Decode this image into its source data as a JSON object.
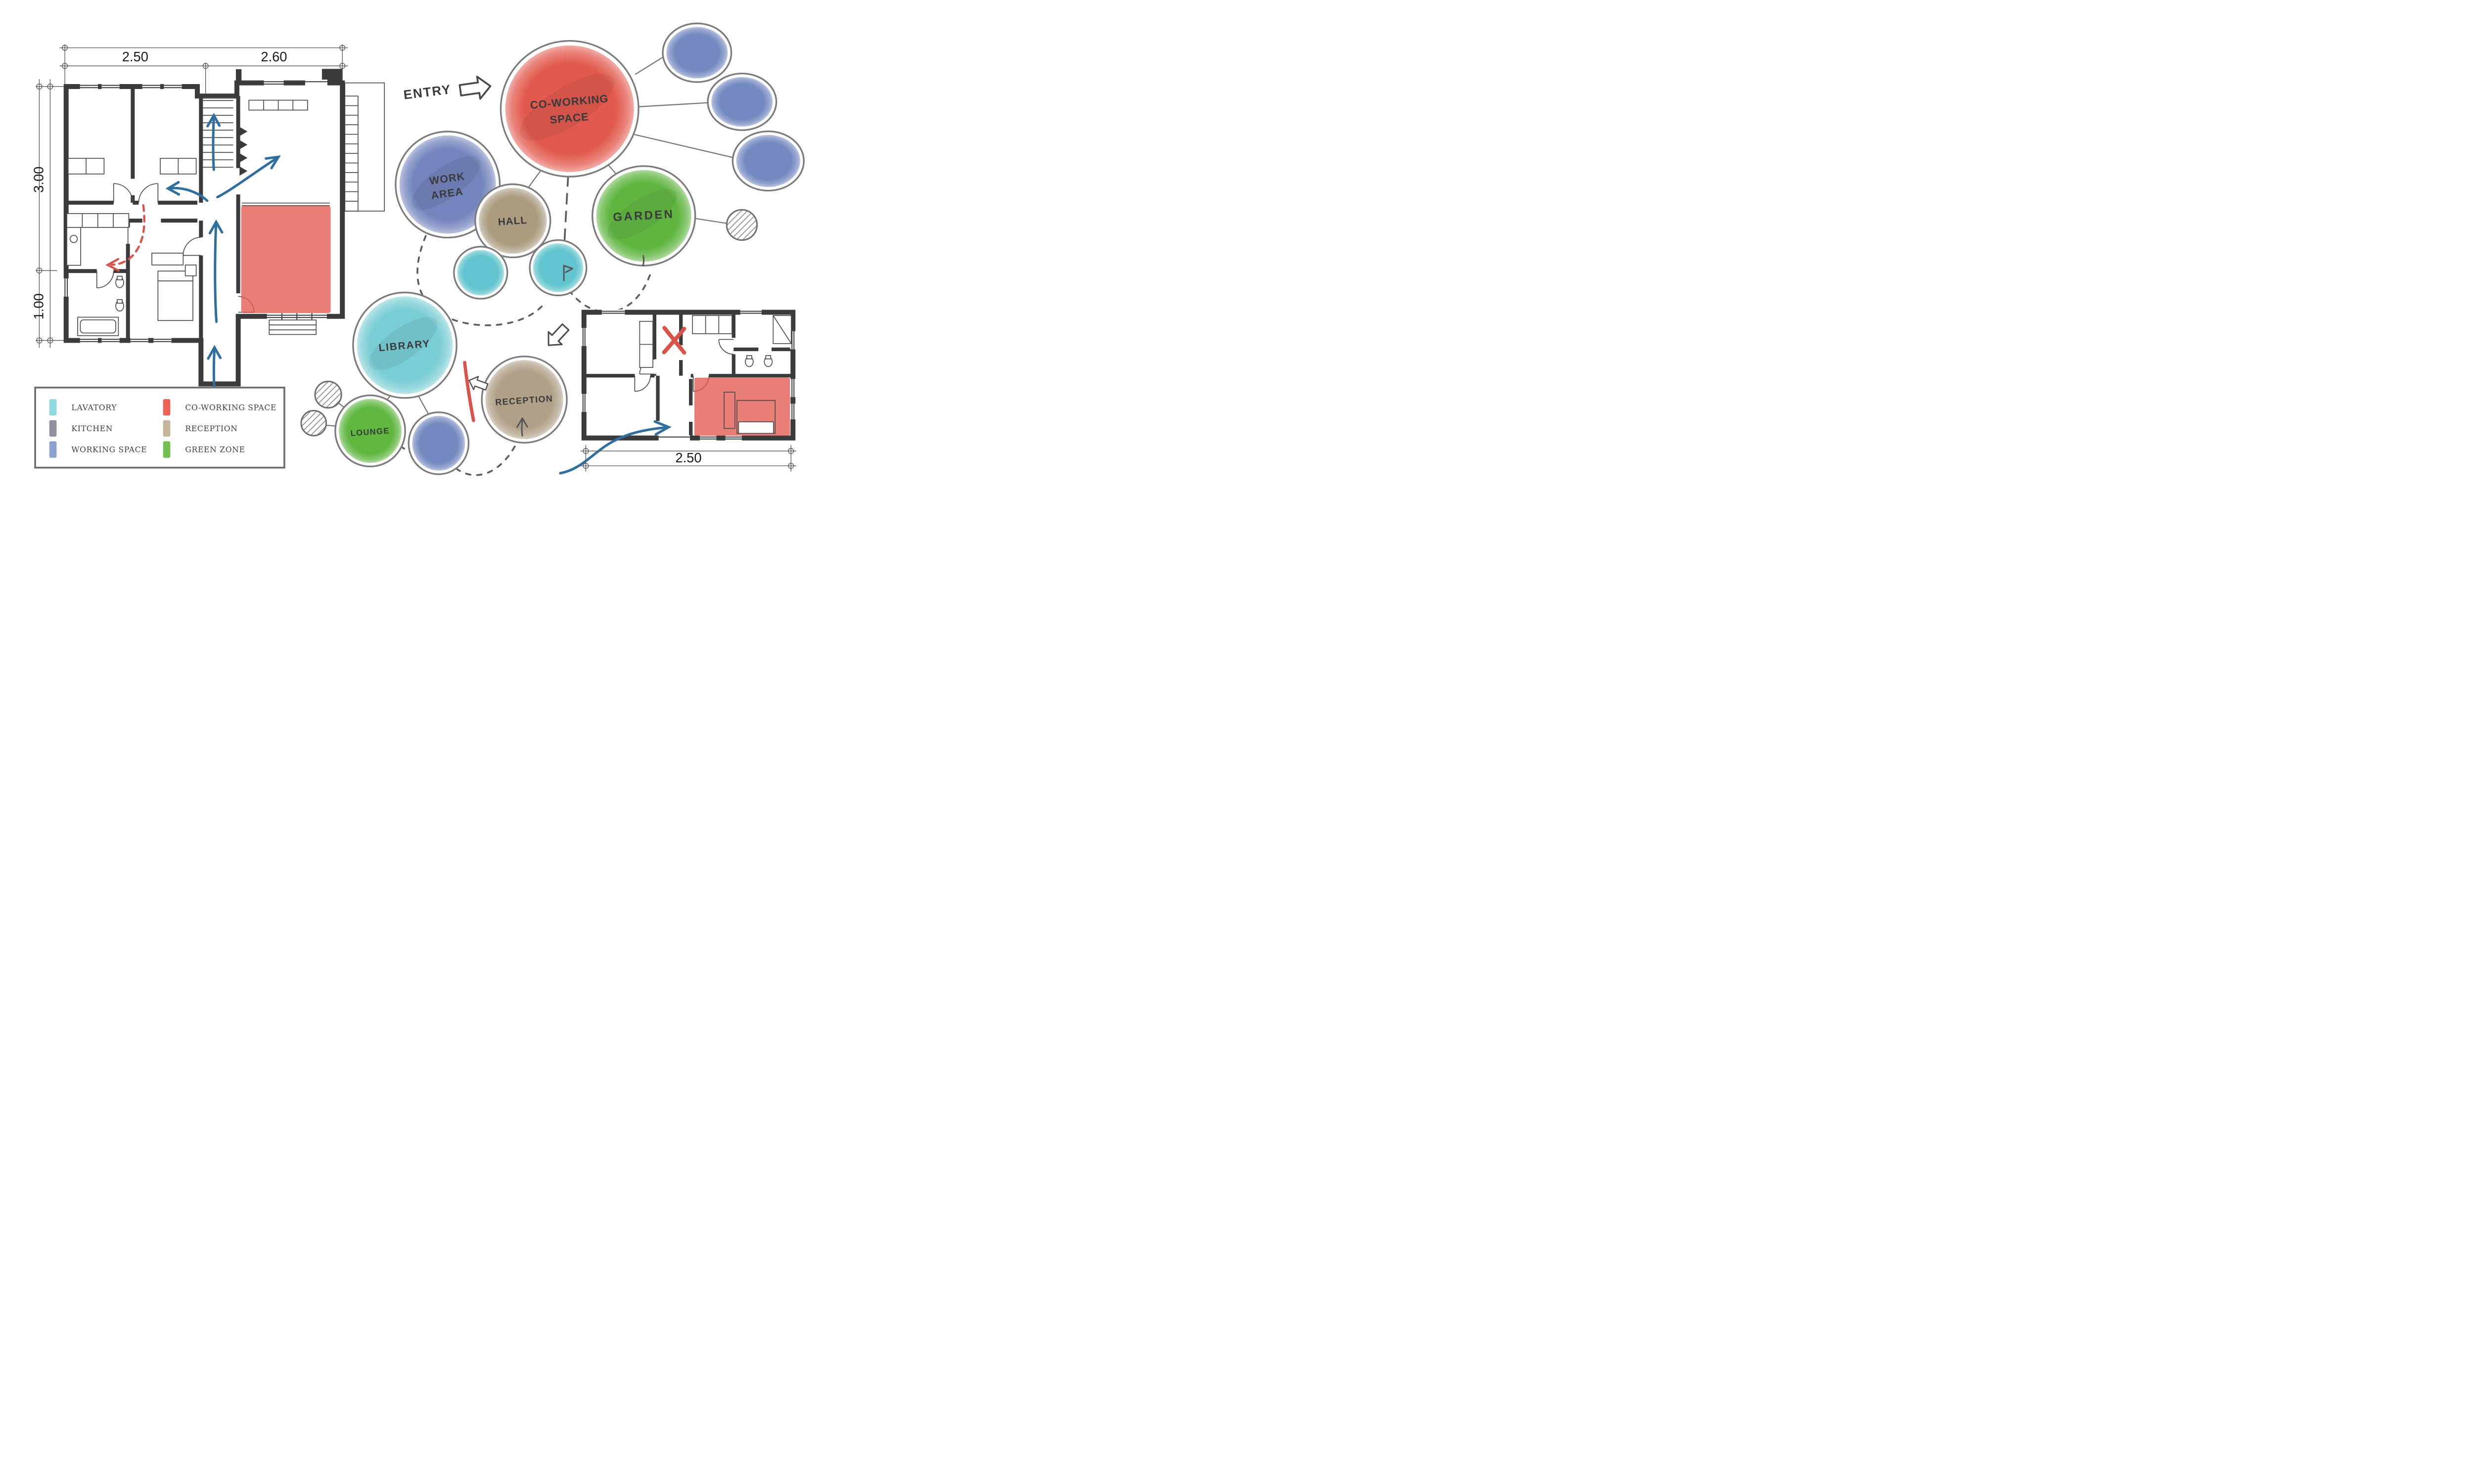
{
  "entry": {
    "label": "ENTRY"
  },
  "bubbles": {
    "co_working": {
      "line1": "CO-WORKING",
      "line2": "SPACE",
      "color": "#e25a4e"
    },
    "work_area": {
      "line1": "WORK",
      "line2": "AREA",
      "color": "#7485bd"
    },
    "hall": {
      "label": "HALL",
      "color": "#ab9c80"
    },
    "garden": {
      "label": "GARDEN",
      "color": "#60b541"
    },
    "library": {
      "label": "LIBRARY",
      "color": "#79cdd4"
    },
    "lounge": {
      "label": "LOUNGE",
      "color": "#5fb740"
    },
    "reception": {
      "label": "RECEPTION",
      "color": "#b0a088"
    },
    "lavatory_small_color": "#61c4ce",
    "satellite_blue_color": "#7489c0"
  },
  "legend": {
    "items": [
      {
        "label": "LAVATORY",
        "color": "#8ed8de"
      },
      {
        "label": "KITCHEN",
        "color": "#928fa0"
      },
      {
        "label": "WORKING SPACE",
        "color": "#8ba1d1"
      },
      {
        "label": "CO-WORKING SPACE",
        "color": "#ec6256"
      },
      {
        "label": "RECEPTION",
        "color": "#c6b69c"
      },
      {
        "label": "GREEN ZONE",
        "color": "#72c052"
      }
    ]
  },
  "plan_left": {
    "dim_width_left": "2.50",
    "dim_width_right": "2.60",
    "dim_height_top": "3.00",
    "dim_height_bottom": "1.00"
  },
  "plan_right": {
    "dim_width": "2.50"
  },
  "colors": {
    "flow_arrow": "#2e6f9f",
    "alert_red": "#d9534a",
    "wall": "#3b3b3e",
    "connector": "#7a7a7a",
    "dashed": "#5e5e5e"
  }
}
